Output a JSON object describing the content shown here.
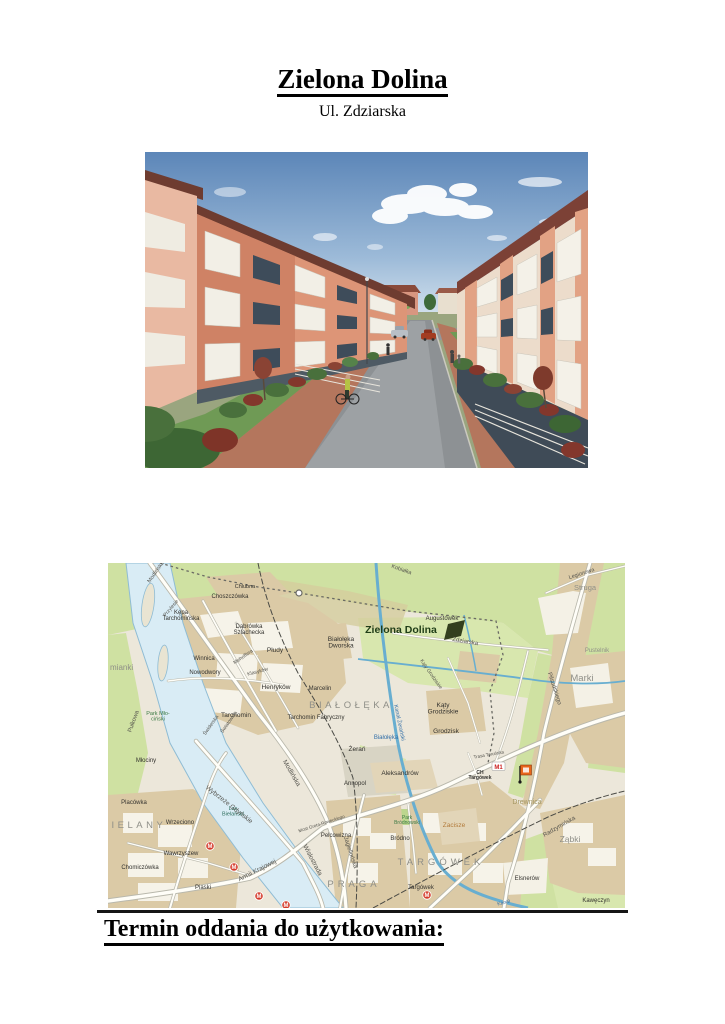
{
  "document": {
    "title": "Zielona Dolina",
    "subtitle": "Ul. Zdziarska",
    "closing_heading": "Termin oddania do użytkowania:"
  },
  "map": {
    "project_color": "#1f3d17",
    "m1_label": "M1",
    "metro_letter": "M",
    "metro_stations": [
      {
        "x": 102,
        "y": 283
      },
      {
        "x": 126,
        "y": 304
      },
      {
        "x": 151,
        "y": 333
      },
      {
        "x": 178,
        "y": 342
      },
      {
        "x": 319,
        "y": 332
      }
    ],
    "labels": [
      {
        "text": "Chlubna",
        "x": 137,
        "y": 25,
        "size": 5.5
      },
      {
        "text": "Choszczówka",
        "x": 122,
        "y": 35,
        "size": 6
      },
      {
        "lines": [
          "Kępa",
          "Tarchomińska"
        ],
        "x": 73,
        "y": 51,
        "size": 6
      },
      {
        "lines": [
          "Dąbrówka",
          "Szlachecka"
        ],
        "x": 141,
        "y": 65,
        "size": 6
      },
      {
        "text": "Płudy",
        "x": 167,
        "y": 89,
        "size": 6.5
      },
      {
        "lines": [
          "Białołęka",
          "Dworska"
        ],
        "x": 233,
        "y": 78,
        "size": 6.5
      },
      {
        "text": "Winnica",
        "x": 96,
        "y": 97,
        "size": 6
      },
      {
        "text": "Nowodwory",
        "x": 97,
        "y": 111,
        "size": 6
      },
      {
        "text": "Henryków",
        "x": 168,
        "y": 126,
        "size": 6.5
      },
      {
        "text": "Marcelin",
        "x": 212,
        "y": 127,
        "size": 6
      },
      {
        "text": "BIAŁOŁĘKA",
        "x": 243,
        "y": 145,
        "size": 9.5,
        "color": "#8f8f88",
        "spacing": 3.5
      },
      {
        "text": "Tarchomin",
        "x": 128,
        "y": 154,
        "size": 6.5
      },
      {
        "text": "Tarchomin Fabryczny",
        "x": 208,
        "y": 156,
        "size": 6
      },
      {
        "text": "mianki",
        "x": 2,
        "y": 107,
        "size": 8,
        "color": "#8f8f88",
        "anchor": "start"
      },
      {
        "text": "Pułkowa",
        "x": 27,
        "y": 159,
        "size": 6,
        "rotate": -70,
        "color": "#55544e"
      },
      {
        "lines": [
          "Park Mło-",
          "ciński"
        ],
        "x": 50,
        "y": 152,
        "size": 5.5,
        "color": "#3c7a44"
      },
      {
        "text": "Przylesie",
        "x": 64,
        "y": 46,
        "size": 5,
        "rotate": -50,
        "color": "#55544e"
      },
      {
        "text": "Mehoffera",
        "x": 136,
        "y": 95,
        "size": 5,
        "rotate": -35,
        "color": "#55544e"
      },
      {
        "text": "Klasyków",
        "x": 150,
        "y": 110,
        "size": 5,
        "rotate": -15,
        "color": "#55544e"
      },
      {
        "text": "Świderska",
        "x": 104,
        "y": 163,
        "size": 5,
        "rotate": -55,
        "color": "#55544e"
      },
      {
        "text": "Światowida",
        "x": 122,
        "y": 160,
        "size": 5,
        "rotate": -55,
        "color": "#55544e"
      },
      {
        "text": "Modlińska",
        "x": 49,
        "y": 10,
        "size": 5.5,
        "rotate": -55,
        "color": "#55544e"
      },
      {
        "text": "Zielona Dolina",
        "x": 293,
        "y": 70,
        "size": 10.5,
        "color": "#1f3d17",
        "weight": "bold"
      },
      {
        "text": "Augustówek",
        "x": 334,
        "y": 57,
        "size": 6
      },
      {
        "text": "Zdziarska",
        "x": 357,
        "y": 80,
        "size": 6,
        "rotate": 10,
        "color": "#55544e"
      },
      {
        "text": "Kąty Grodziskie",
        "x": 322,
        "y": 112,
        "size": 5,
        "rotate": 55,
        "color": "#55544e"
      },
      {
        "lines": [
          "Kąty",
          "Grodziskie"
        ],
        "x": 335,
        "y": 144,
        "size": 6.5
      },
      {
        "text": "Grodzisk",
        "x": 338,
        "y": 170,
        "size": 6.5
      },
      {
        "text": "Białołęka",
        "x": 278,
        "y": 176,
        "size": 6,
        "color": "#3470a8"
      },
      {
        "text": "Żerań",
        "x": 249,
        "y": 188,
        "size": 6.5
      },
      {
        "text": "Annopol",
        "x": 247,
        "y": 222,
        "size": 6
      },
      {
        "text": "Aleksandrów",
        "x": 292,
        "y": 212,
        "size": 6.5
      },
      {
        "text": "Pelcowizna",
        "x": 228,
        "y": 274,
        "size": 6
      },
      {
        "text": "PRAGA",
        "x": 246,
        "y": 324,
        "size": 9.5,
        "color": "#8f8f88",
        "spacing": 4
      },
      {
        "text": "Bródno",
        "x": 292,
        "y": 277,
        "size": 6
      },
      {
        "lines": [
          "Park",
          "Bródnowski"
        ],
        "x": 299,
        "y": 256,
        "size": 5,
        "color": "#3c7a44"
      },
      {
        "text": "Zacisze",
        "x": 346,
        "y": 264,
        "size": 6.5,
        "color": "#b27a3a"
      },
      {
        "text": "TARGÓWEK",
        "x": 333,
        "y": 302,
        "size": 9.5,
        "color": "#8f8f88",
        "spacing": 4
      },
      {
        "text": "Targówek",
        "x": 313,
        "y": 326,
        "size": 6
      },
      {
        "text": "Elsnerów",
        "x": 419,
        "y": 317,
        "size": 6
      },
      {
        "text": "Kawęczyn",
        "x": 488,
        "y": 339,
        "size": 6
      },
      {
        "text": "Drewnica",
        "x": 419,
        "y": 241,
        "size": 7,
        "color": "#a39560"
      },
      {
        "text": "Ząbki",
        "x": 462,
        "y": 279,
        "size": 8.5,
        "color": "#8f8f88"
      },
      {
        "text": "Marki",
        "x": 474,
        "y": 118,
        "size": 9.5,
        "color": "#8f8f88"
      },
      {
        "text": "Struga",
        "x": 477,
        "y": 27,
        "size": 7.5,
        "color": "#8f8f88"
      },
      {
        "text": "Pustelnik",
        "x": 489,
        "y": 89,
        "size": 6,
        "color": "#8f8f88"
      },
      {
        "text": "Młociny",
        "x": 38,
        "y": 199,
        "size": 6
      },
      {
        "text": "Placówka",
        "x": 26,
        "y": 241,
        "size": 6
      },
      {
        "text": "BIELANY",
        "x": 26,
        "y": 265,
        "size": 9.5,
        "color": "#8f8f88",
        "spacing": 3.5
      },
      {
        "text": "Wrzeciono",
        "x": 72,
        "y": 261,
        "size": 6
      },
      {
        "lines": [
          "Las",
          "Bielański"
        ],
        "x": 125,
        "y": 247,
        "size": 5.5,
        "color": "#2e6e5e"
      },
      {
        "text": "Wybrzeże Gdyńskie",
        "x": 120,
        "y": 243,
        "size": 6.5,
        "rotate": 38,
        "color": "#55544e"
      },
      {
        "text": "Modlińska",
        "x": 182,
        "y": 211,
        "size": 6.5,
        "rotate": 60,
        "color": "#55544e"
      },
      {
        "text": "Wisłostrada",
        "x": 203,
        "y": 298,
        "size": 6.5,
        "rotate": 62,
        "color": "#55544e"
      },
      {
        "text": "Armii Krajowej",
        "x": 150,
        "y": 309,
        "size": 6.5,
        "rotate": -27,
        "color": "#55544e"
      },
      {
        "text": "Jagiellońska",
        "x": 241,
        "y": 290,
        "size": 6,
        "rotate": 72,
        "color": "#55544e"
      },
      {
        "text": "Most Grota-Roweckiego",
        "x": 214,
        "y": 262,
        "size": 4.5,
        "rotate": -18,
        "color": "#55544e"
      },
      {
        "text": "Wawrzyszew",
        "x": 73,
        "y": 292,
        "size": 6
      },
      {
        "text": "Chomiczówka",
        "x": 32,
        "y": 306,
        "size": 6
      },
      {
        "text": "Piaski",
        "x": 95,
        "y": 326,
        "size": 6
      },
      {
        "text": "Trasa Toruńska",
        "x": 381,
        "y": 193,
        "size": 4.5,
        "rotate": -10,
        "color": "#55544e"
      },
      {
        "lines": [
          "CH",
          "Targówek"
        ],
        "x": 372,
        "y": 211,
        "size": 5,
        "weight": "bold"
      },
      {
        "text": "Radzymińska",
        "x": 452,
        "y": 265,
        "size": 6,
        "rotate": -30,
        "color": "#55544e"
      },
      {
        "text": "Legionowa",
        "x": 474,
        "y": 12,
        "size": 5.5,
        "rotate": -18,
        "color": "#55544e"
      },
      {
        "text": "Piłsudskiego",
        "x": 445,
        "y": 126,
        "size": 6,
        "rotate": 72,
        "color": "#55544e"
      },
      {
        "text": "Kanał Żerański",
        "x": 290,
        "y": 160,
        "size": 5.5,
        "rotate": 78,
        "color": "#3470a8"
      },
      {
        "text": "Kobiałka",
        "x": 293,
        "y": 8,
        "size": 5.5,
        "rotate": 20,
        "color": "#55544e"
      },
      {
        "text": "Kanał",
        "x": 396,
        "y": 341,
        "size": 5,
        "rotate": -15,
        "color": "#3470a8"
      }
    ]
  }
}
